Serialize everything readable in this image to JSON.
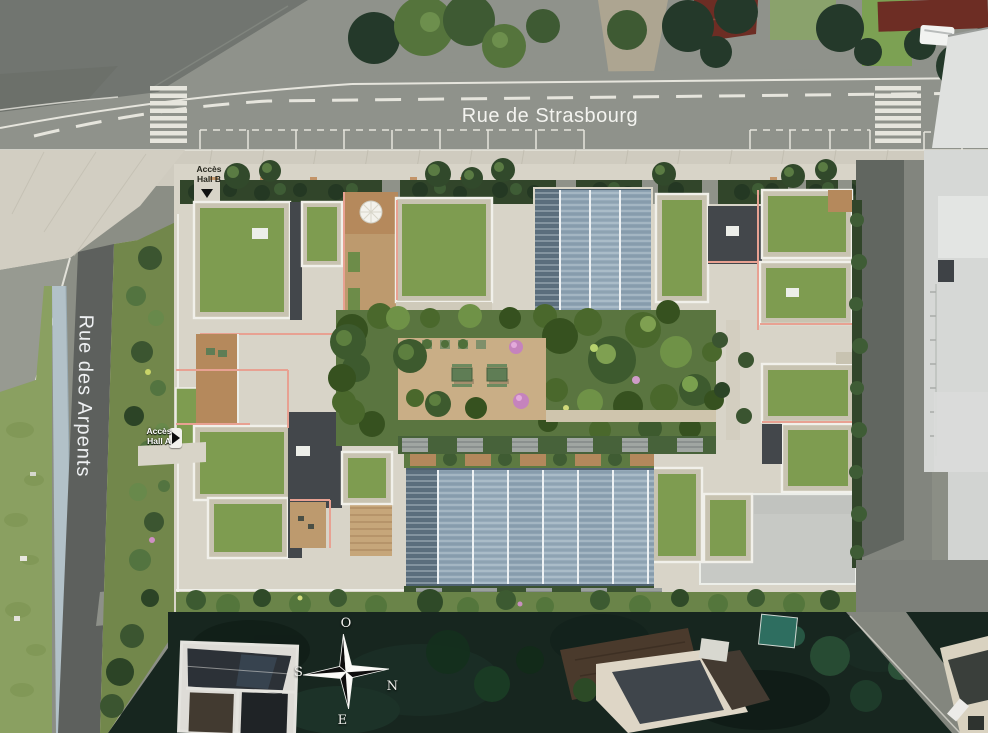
{
  "streets": {
    "strasbourg": "Rue de Strasbourg",
    "arpents": "Rue des Arpents"
  },
  "access": {
    "hall_b": {
      "line1": "Accès",
      "line2": "Hall B"
    },
    "hall_a": {
      "line1": "Accès",
      "line2": "Hall A"
    }
  },
  "compass": {
    "west": "O",
    "south": "S",
    "north": "N",
    "east": "E"
  },
  "colors": {
    "road": "#8f928b",
    "roadDark": "#5d605d",
    "marking": "#e6e5dd",
    "sidewalk": "#cfcbbf",
    "concrete": "#d8d4c8",
    "lawn": "#8aa061",
    "gardenGreen": "#72874b",
    "roofGrass": "#7e9c50",
    "gravel": "#c8c3b1",
    "hedge": "#31452a",
    "darkRoof": "#43474b",
    "parapet": "#f1f0ea",
    "glass": "#8da2b2",
    "glassDark": "#5a6d7c",
    "terracotta": "#b5895c",
    "salmon": "#e8a192",
    "courtyardPave": "#c9ae86",
    "grayBuilding": "#d6d8d6",
    "driveway": "#82857e",
    "darkTeal": "#17261f",
    "blueStrip": "#b2c1c8",
    "redRoof": "#6d2d24",
    "poolTeal": "#2e6e60",
    "whiteBldg": "#dedcd7",
    "veg": "#5a7540"
  }
}
